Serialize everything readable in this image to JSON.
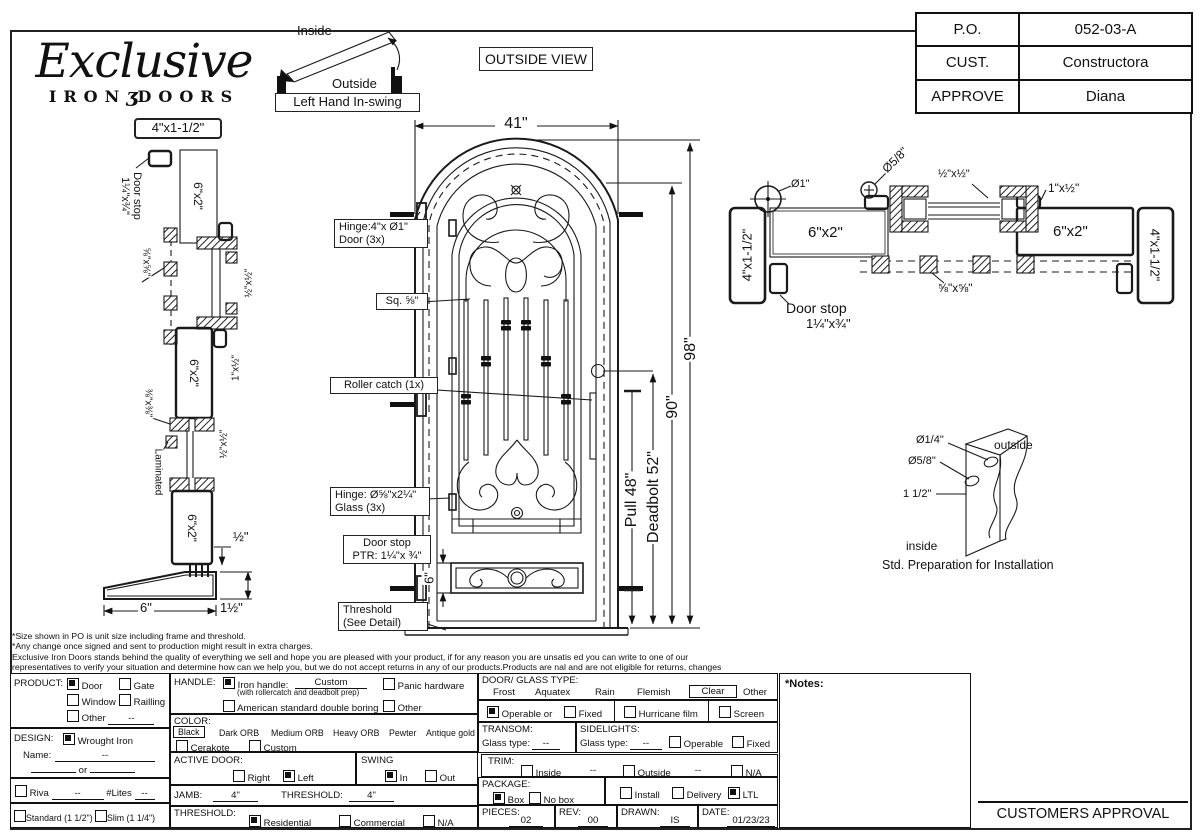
{
  "header": {
    "brand": {
      "name": "Exclusive",
      "word_left": "IRON",
      "word_glyph": "ʒ",
      "word_right": "DOORS"
    },
    "po_table": {
      "rows": [
        [
          "P.O.",
          "052-03-A"
        ],
        [
          "CUST.",
          "Constructora"
        ],
        [
          "APPROVE",
          "Diana"
        ]
      ]
    },
    "swing": {
      "inside": "Inside",
      "outside": "Outside",
      "caption": "Left Hand In-swing"
    },
    "view_label": "OUTSIDE VIEW"
  },
  "left_section": {
    "frame_top": "4\"x1-1/2\"",
    "door_stop_1": "Door stop",
    "door_stop_2": "1¼\"x¾\"",
    "tube_top": "6\"x2\"",
    "anchor": "⅝\"x⅝\"",
    "transom_tube": "½\"x½\"",
    "stop_small": "1\"x½\"",
    "tube_mid": "6\"x2\"",
    "rail_bottom": "⅜\"x⅜\"",
    "glass_stop": "½\"x½\"",
    "glass": "Laminated",
    "tube_bottom": "6\"x2\"",
    "gap": "½\"",
    "threshold_w": "6\"",
    "threshold_h": "1½\""
  },
  "door": {
    "width": "41\"",
    "h_total": "98\"",
    "h_door": "90\"",
    "pull": "Pull 48\"",
    "deadbolt": "Deadbolt 52\"",
    "kick": "6\"",
    "hinge_door_1": "Hinge:4\"x Ø1\"",
    "hinge_door_2": "Door (3x)",
    "sq": "Sq. ⅝\"",
    "roller": "Roller catch  (1x)",
    "hinge_glass_1": "Hinge: Ø⅝\"x2¼\"",
    "hinge_glass_2": "Glass (3x)",
    "stop_1": "Door stop",
    "stop_2": "PTR: 1¼\"x ¾\"",
    "threshold_1": "Threshold",
    "threshold_2": "(See Detail)"
  },
  "right_section": {
    "dia_1": "Ø1\"",
    "dia_58": "Ø5/8\"",
    "transom_tube": "½\"x½\"",
    "stop_small": "1\"x½\"",
    "tube_left": "6\"x2\"",
    "tube_right": "6\"x2\"",
    "frame_left": "4\"x1-1/2\"",
    "frame_right": "4\"x1-1/2\"",
    "door_stop_1": "Door stop",
    "door_stop_2": "1¼\"x¾\"",
    "anchor": "⅝\"x⅝\""
  },
  "install": {
    "dia_14": "Ø1/4\"",
    "dia_58": "Ø5/8\"",
    "offset": "1 1/2\"",
    "outside": "outside",
    "inside": "inside",
    "caption": "Std. Preparation for Installation"
  },
  "disclaimer": {
    "l1": "*Size shown in PO is unit size including frame and threshold.",
    "l2": "*Any change once signed and sent to production might result in extra charges.",
    "l3": "Exclusive Iron Doors stands behind the quality of everything we sell and hope you are pleased with your product, if for any reason you are unsatis  ed you can write to one of our",
    "l4": "representatives to verify your situation and determine how can we help you, but we do not accept returns in any of our products.Products are   nal and are not eligible for returns, changes",
    "l5": "or alterations.By signing you agree to our terms and conditions, delivery pdf and forms of payment. *Doors measurements do not include the gaps between jambs"
  },
  "form": {
    "product": {
      "label": "PRODUCT:",
      "o1": {
        "t": "Door",
        "c": true
      },
      "o2": {
        "t": "Gate",
        "c": false
      },
      "o3": {
        "t": "Window",
        "c": false
      },
      "o4": {
        "t": "Railling",
        "c": false
      },
      "o5": {
        "t": "Other",
        "c": false
      },
      "other_val": "--"
    },
    "design": {
      "label": "DESIGN:",
      "o1": {
        "t": "Wrought Iron",
        "c": true
      },
      "name_label": "Name:",
      "name_val": "--",
      "or": "or"
    },
    "riva": {
      "o1": {
        "t": "Riva",
        "c": false
      },
      "val": "--",
      "lites": "#Lites",
      "lites_val": "--"
    },
    "profile": {
      "o1": {
        "t": "Standard (1 1/2\")",
        "c": false
      },
      "o2": {
        "t": "Slim (1 1/4\")",
        "c": false
      }
    },
    "handle": {
      "label": "HANDLE:",
      "o1": {
        "t": "Iron handle:",
        "c": true
      },
      "custom": "Custom",
      "note": "(with rollercatch and deadbolt prep)",
      "o2": {
        "t": "American standard double boring",
        "c": false
      },
      "o3": {
        "t": "Panic hardware",
        "c": false
      },
      "o4": {
        "t": "Other",
        "c": false
      }
    },
    "color": {
      "label": "COLOR:",
      "selected": "Black",
      "w1": "Dark ORB",
      "w2": "Medium ORB",
      "w3": "Heavy ORB",
      "w4": "Pewter",
      "w5": "Antique gold",
      "o1": {
        "t": "Cerakote",
        "c": false
      },
      "o2": {
        "t": "Custom",
        "c": false
      }
    },
    "active": {
      "label": "ACTIVE DOOR:",
      "o1": {
        "t": "Right",
        "c": false
      },
      "o2": {
        "t": "Left",
        "c": true
      }
    },
    "swing": {
      "label": "SWING",
      "o1": {
        "t": "In",
        "c": true
      },
      "o2": {
        "t": "Out",
        "c": false
      }
    },
    "jamb": {
      "label": "JAMB:",
      "val": "4\"",
      "t_label": "THRESHOLD:",
      "t_val": "4\""
    },
    "threshold": {
      "label": "THRESHOLD:",
      "o1": {
        "t": "Residential",
        "c": true
      },
      "o2": {
        "t": "Commercial",
        "c": false
      },
      "o3": {
        "t": "N/A",
        "c": false
      }
    },
    "glass": {
      "label": "DOOR/ GLASS TYPE:",
      "w1": "Frost",
      "w2": "Aquatex",
      "w3": "Rain",
      "w4": "Flemish",
      "selected": "Clear",
      "w5": "Other"
    },
    "operable": {
      "o1": {
        "t": "Operable  or",
        "c": true
      },
      "o2": {
        "t": "Fixed",
        "c": false
      },
      "o3": {
        "t": "Hurricane film",
        "c": false
      },
      "o4": {
        "t": "Screen",
        "c": false
      }
    },
    "transom": {
      "label": "TRANSOM:",
      "glass_label": "Glass type:",
      "val": "--"
    },
    "sidelights": {
      "label": "SIDELIGHTS:",
      "glass_label": "Glass type:",
      "val": "--",
      "o1": {
        "t": "Operable",
        "c": false
      },
      "o2": {
        "t": "Fixed",
        "c": false
      }
    },
    "trim": {
      "label": "TRIM:",
      "o1": {
        "t": "Inside",
        "c": false
      },
      "v1": "--",
      "o2": {
        "t": "Outside",
        "c": false
      },
      "v2": "--",
      "o3": {
        "t": "N/A",
        "c": false
      }
    },
    "package": {
      "label": "PACKAGE:",
      "o1": {
        "t": "Box",
        "c": true
      },
      "o2": {
        "t": "No box",
        "c": false
      },
      "o3": {
        "t": "Install",
        "c": false
      },
      "o4": {
        "t": "Delivery",
        "c": false
      },
      "o5": {
        "t": "LTL",
        "c": true
      }
    },
    "meta": {
      "pieces_label": "PIECES:",
      "pieces": "02",
      "rev_label": "REV:",
      "rev": "00",
      "drawn_label": "DRAWN:",
      "drawn": "IS",
      "date_label": "DATE:",
      "date": "01/23/23"
    }
  },
  "notes_label": "*Notes:",
  "approval_label": "CUSTOMERS APPROVAL"
}
